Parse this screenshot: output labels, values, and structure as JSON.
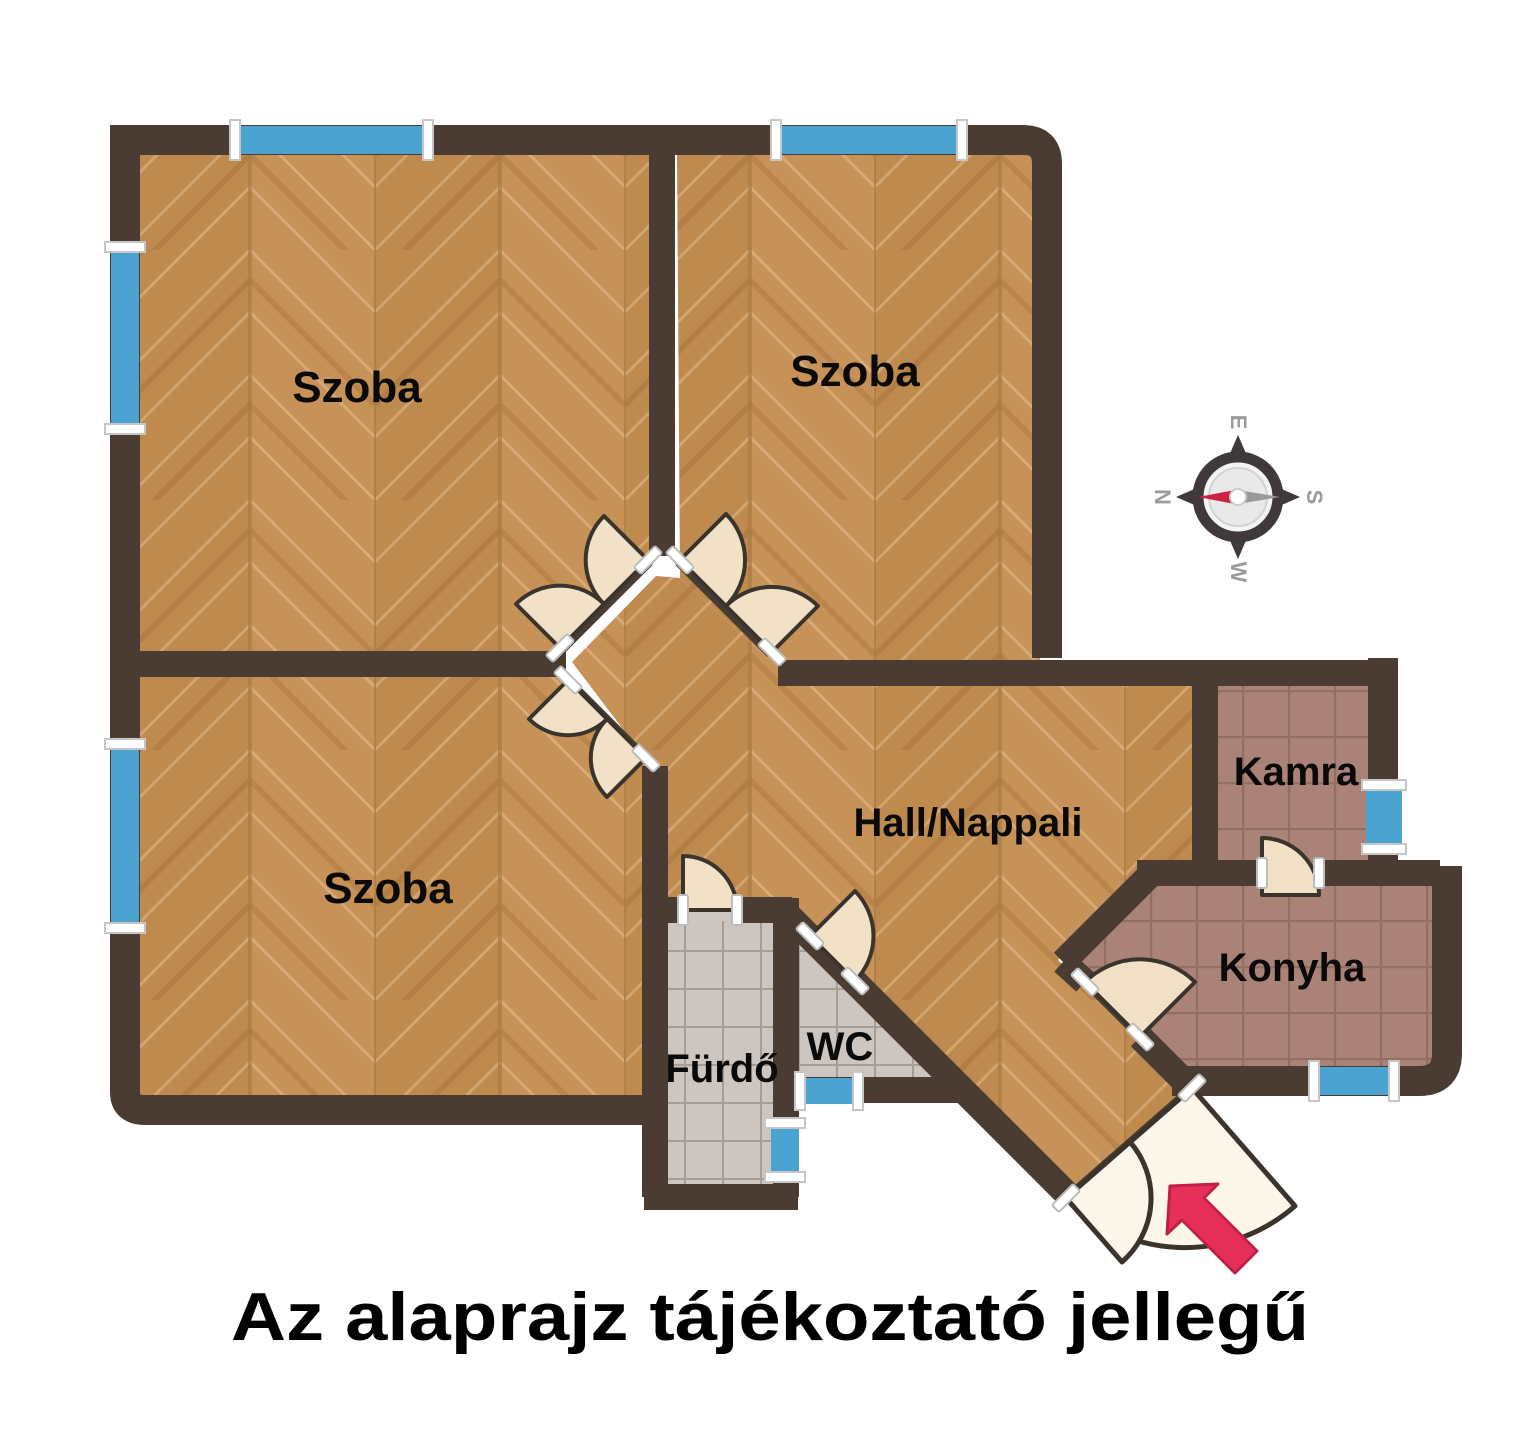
{
  "title": "Az alaprajz tájékoztató jellegű",
  "rooms": [
    {
      "id": "szoba-top-left",
      "label": "Szoba"
    },
    {
      "id": "szoba-top-right",
      "label": "Szoba"
    },
    {
      "id": "szoba-bottom-left",
      "label": "Szoba"
    },
    {
      "id": "hall-nappali",
      "label": "Hall/Nappali"
    },
    {
      "id": "kamra",
      "label": "Kamra"
    },
    {
      "id": "konyha",
      "label": "Konyha"
    },
    {
      "id": "furdo",
      "label": "Fürdő"
    },
    {
      "id": "wc",
      "label": "WC"
    }
  ],
  "compass": {
    "north": "N",
    "east": "E",
    "south": "S",
    "west": "W"
  },
  "colors": {
    "wall": "#4a3c33",
    "wood-base": "#c79257",
    "wood-alt": "#bf8a4e",
    "wood-line": "#a87a42",
    "tile-mauve": "#aa8278",
    "tile-mauve-line": "#7d5c52",
    "tile-gray": "#cdc6c0",
    "tile-gray-line": "#8d827b",
    "window-blue": "#4ba3d2",
    "door-cream": "#f2e1c6",
    "door-entrance": "#fdf6ea",
    "door-stroke": "#3b342d",
    "arrow-red": "#e73059",
    "compass-dark": "#3f3939",
    "compass-letter": "#9b9b9b",
    "needle-red": "#cc2244",
    "needle-gray": "#999999",
    "label-color": "#0a0a0a"
  }
}
